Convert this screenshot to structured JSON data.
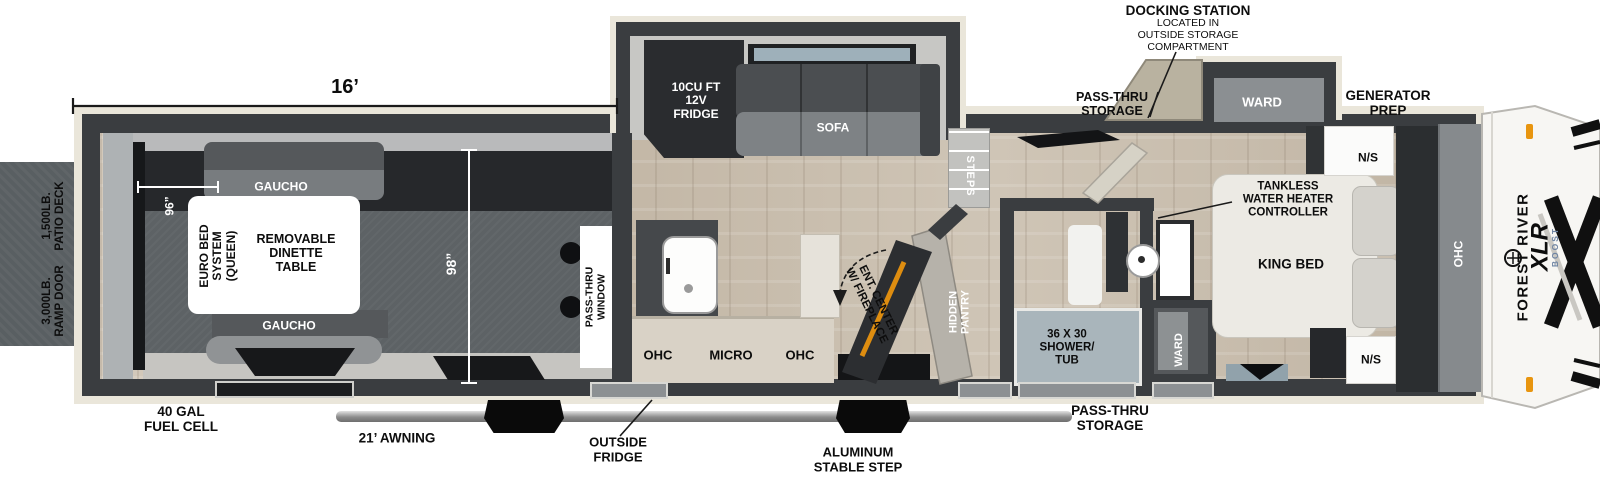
{
  "title": "Forest River XLR Boost Toy Hauler Floorplan",
  "colors": {
    "wall": "#3a3d40",
    "outline": "#eae6da",
    "wood": "#cbc0b2",
    "garage_dark_band": "#26282b",
    "garage_floor": "#5d6265",
    "deck_gray": "#595f62",
    "shower_blue": "#a9b5bb",
    "fireplace_orange": "#e8930f",
    "boost_blue": "#6e84a3",
    "cap_white": "#f7f6f3"
  },
  "dims": {
    "garage_length": "16’",
    "garage_width_96": "96”",
    "garage_width_98": "98”"
  },
  "exterior": {
    "docking_station": [
      "DOCKING STATION",
      "LOCATED IN",
      "OUTSIDE STORAGE",
      "COMPARTMENT"
    ],
    "pass_thru_storage_top": [
      "PASS-THRU",
      "STORAGE"
    ],
    "generator_prep": [
      "GENERATOR",
      "PREP"
    ],
    "patio_deck": [
      "1,500LB.",
      "PATIO DECK"
    ],
    "ramp_door": [
      "3,000LB.",
      "RAMP DOOR"
    ],
    "fuel_cell": [
      "40 GAL",
      "FUEL CELL"
    ],
    "awning": "21’ AWNING",
    "outside_fridge": [
      "OUTSIDE",
      "FRIDGE"
    ],
    "stable_step": [
      "ALUMINUM",
      "STABLE STEP"
    ],
    "pass_thru_storage_bottom": [
      "PASS-THRU",
      "STORAGE"
    ]
  },
  "garage": {
    "gaucho_top": "GAUCHO",
    "gaucho_bottom": "GAUCHO",
    "euro_bed": [
      "EURO BED",
      "SYSTEM",
      "(QUEEN)"
    ],
    "dinette": [
      "REMOVABLE",
      "DINETTE",
      "TABLE"
    ],
    "pass_thru_window": [
      "PASS-THRU",
      "WINDOW"
    ]
  },
  "living": {
    "fridge": [
      "10CU FT",
      "12V",
      "FRIDGE"
    ],
    "sofa": "SOFA",
    "ohc_left": "OHC",
    "micro": "MICRO",
    "ohc_right": "OHC",
    "ent_center": [
      "ENT. CENTER",
      "W/ FIREPLACE"
    ],
    "hidden_pantry": [
      "HIDDEN",
      "PANTRY"
    ],
    "steps": "STEPS"
  },
  "bath": {
    "shower": [
      "36 X 30",
      "SHOWER/",
      "TUB"
    ],
    "ward": "WARD"
  },
  "bedroom": {
    "tankless": [
      "TANKLESS",
      "WATER HEATER",
      "CONTROLLER"
    ],
    "king_bed": "KING BED",
    "ns_top": "N/S",
    "ns_bottom": "N/S",
    "ward_slide": "WARD",
    "ohc": "OHC"
  },
  "brand": {
    "make": "FOREST RIVER",
    "model": "XLR",
    "series": "BOOST"
  }
}
